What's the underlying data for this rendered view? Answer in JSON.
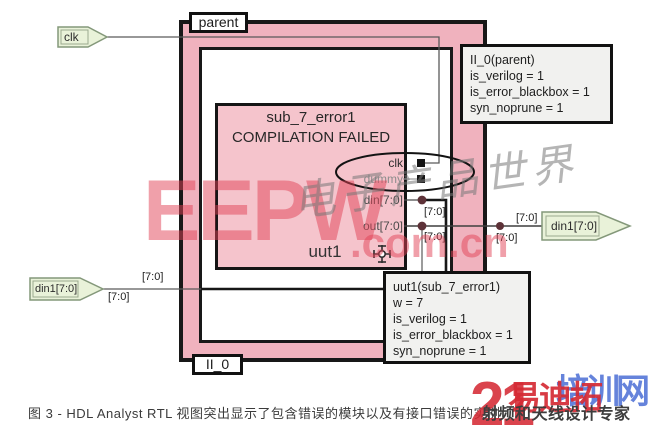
{
  "colors": {
    "highlight_pink": "#f0b2be",
    "module_pink": "#f5c4cc",
    "port_green": "#e9f2d9",
    "callout_gray": "#f1f1ef",
    "watermark_red": "#e1415a",
    "watermark_blue": "#3c64d2"
  },
  "diagram": {
    "parent_module_label": "parent",
    "parent_instance_label": "II_0",
    "bus_label": "[7:0]",
    "input_ports": {
      "clk": "clk",
      "din1": "din1[7:0]"
    },
    "output_ports": {
      "din1": "din1[7:0]"
    },
    "sub_module": {
      "name": "sub_7_error1",
      "status": "COMPILATION FAILED",
      "instance": "uut1",
      "pins": [
        "clk",
        "dummy",
        "din[7:0]",
        "out[7:0]"
      ]
    },
    "callouts": {
      "parent": {
        "lines": [
          "II_0(parent)",
          "is_verilog = 1",
          "is_error_blackbox = 1",
          "syn_noprune = 1"
        ]
      },
      "uut1": {
        "lines": [
          "uut1(sub_7_error1)",
          "w = 7",
          "is_verilog = 1",
          "is_error_blackbox = 1",
          "syn_noprune = 1"
        ]
      }
    }
  },
  "caption": "图 3 - HDL Analyst RTL 视图突出显示了包含错误的模块以及有接口错误的实例",
  "watermarks": {
    "center": {
      "brand": "EEPW",
      "suffix": ".com.cn",
      "script": "电子产品世界"
    },
    "corner": {
      "big_number": "21",
      "red_text": "易迪拓",
      "blue_text": "培训网",
      "slogan": "射频和天线设计专家"
    }
  }
}
